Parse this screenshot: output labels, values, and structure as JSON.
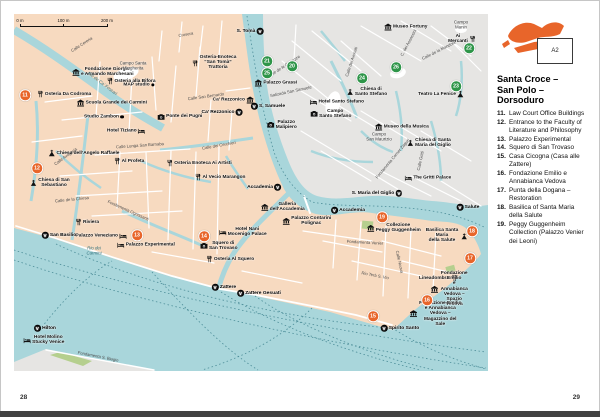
{
  "page": {
    "left_number": "28",
    "right_number": "29"
  },
  "sidebar": {
    "locator_label": "A2",
    "title": "Santa Croce –\nSan Polo –\nDorsoduro",
    "list": [
      {
        "num": "11.",
        "text": "Law Court Office Buildings"
      },
      {
        "num": "12.",
        "text": "Entrance to the Faculty of Literature and Philosophy"
      },
      {
        "num": "13.",
        "text": "Palazzo Experimental"
      },
      {
        "num": "14.",
        "text": "Squero di San Trovaso"
      },
      {
        "num": "15.",
        "text": "Casa Cicogna (Casa alle Zattere)"
      },
      {
        "num": "16.",
        "text": "Fondazione Emilio e Annabianca Vedova"
      },
      {
        "num": "17.",
        "text": "Punta della Dogana – Restoration"
      },
      {
        "num": "18.",
        "text": "Basilica of Santa Maria della Salute"
      },
      {
        "num": "19.",
        "text": "Peggy Guggenheim Collection (Palazzo Venier dei Leoni)"
      }
    ]
  },
  "map": {
    "scale_bar": {
      "labels": [
        "0 m",
        "100 m",
        "200 m"
      ]
    },
    "colors": {
      "water": "#A9D6DB",
      "land": "#F7DAC0",
      "district_other": "#E6E5E3",
      "sight_orange": "#E8652A",
      "ref_green": "#2E9549",
      "park": "#B5CF8E"
    },
    "sights": [
      {
        "n": "11",
        "x": 25,
        "y": 95
      },
      {
        "n": "12",
        "x": 37,
        "y": 168
      },
      {
        "n": "13",
        "x": 137,
        "y": 235
      },
      {
        "n": "14",
        "x": 204,
        "y": 236
      },
      {
        "n": "15",
        "x": 373,
        "y": 316
      },
      {
        "n": "16",
        "x": 427,
        "y": 300
      },
      {
        "n": "17",
        "x": 470,
        "y": 258
      },
      {
        "n": "18",
        "x": 472,
        "y": 231
      },
      {
        "n": "19",
        "x": 382,
        "y": 217
      }
    ],
    "refs": [
      {
        "n": "20",
        "x": 292,
        "y": 66
      },
      {
        "n": "21",
        "x": 267,
        "y": 61
      },
      {
        "n": "25",
        "x": 267,
        "y": 73
      },
      {
        "n": "24",
        "x": 362,
        "y": 78
      },
      {
        "n": "26",
        "x": 396,
        "y": 67
      },
      {
        "n": "23",
        "x": 456,
        "y": 86
      },
      {
        "n": "22",
        "x": 469,
        "y": 48
      }
    ],
    "labels": [
      {
        "t": "Fondazione Giorgio\ne Armando Marchesani",
        "icon": "museum-icon",
        "x": 103,
        "y": 72
      },
      {
        "t": "MAP studio",
        "icon": "dot-icon",
        "side": "r",
        "x": 139,
        "y": 85
      },
      {
        "t": "Osteria Da Codroma",
        "icon": "restaurant-icon",
        "x": 64,
        "y": 94
      },
      {
        "t": "Campo Santa\nMargherita",
        "cls": "place",
        "x": 133,
        "y": 66
      },
      {
        "t": "Osteria alla Bifora",
        "icon": "restaurant-icon",
        "x": 131,
        "y": 81
      },
      {
        "t": "Scuola Grande dei Carmini",
        "icon": "museum-icon",
        "x": 112,
        "y": 103
      },
      {
        "t": "Studio Zambon",
        "icon": "dot-icon",
        "side": "r",
        "x": 104,
        "y": 117
      },
      {
        "t": "Osteria-Enoteca\n“San Tomà”\nTrattoria",
        "icon": "restaurant-icon",
        "x": 214,
        "y": 63
      },
      {
        "t": "Ca’ Rezzonico",
        "icon": "museum-icon",
        "side": "r",
        "x": 233,
        "y": 100
      },
      {
        "t": "Ponte dei Pugni",
        "icon": "camera-icon",
        "x": 180,
        "y": 117
      },
      {
        "t": "Hotel Tiziano",
        "icon": "hotel-icon",
        "side": "r",
        "x": 126,
        "y": 131
      },
      {
        "t": "Chiesa dell’Angelo Raffaele",
        "icon": "church-icon",
        "x": 84,
        "y": 153
      },
      {
        "t": "Al Profeta",
        "icon": "restaurant-icon",
        "x": 129,
        "y": 161
      },
      {
        "t": "Chiesa di San\nSebastiano",
        "icon": "church-icon",
        "x": 50,
        "y": 183
      },
      {
        "t": "Osteria Enoteca Ai Artisti",
        "icon": "restaurant-icon",
        "x": 199,
        "y": 163
      },
      {
        "t": "Al Vecio Marangon",
        "icon": "restaurant-icon",
        "x": 220,
        "y": 177
      },
      {
        "t": "Riviera",
        "icon": "restaurant-icon",
        "x": 87,
        "y": 222
      },
      {
        "t": "Palazzo Veneziano",
        "icon": "hotel-icon",
        "side": "r",
        "x": 101,
        "y": 236
      },
      {
        "t": "Palazzo Experimental",
        "icon": "hotel-icon",
        "x": 146,
        "y": 245
      },
      {
        "t": "Squero di\nSan Trovaso",
        "icon": "camera-icon",
        "x": 219,
        "y": 246
      },
      {
        "t": "Hotel Nani\nMocenigo Palace",
        "icon": "hotel-icon",
        "x": 243,
        "y": 232
      },
      {
        "t": "Osteria Al Squero",
        "icon": "restaurant-icon",
        "x": 230,
        "y": 259
      },
      {
        "t": "Galleria\ndell’Accademia",
        "icon": "museum-icon",
        "x": 283,
        "y": 207
      },
      {
        "t": "Palazzo Contarini\nPolignac",
        "icon": "museum-icon",
        "x": 307,
        "y": 221
      },
      {
        "t": "Collezione\nPeggy Guggenheim",
        "icon": "museum-icon",
        "x": 394,
        "y": 228
      },
      {
        "t": "Basilica Santa Maria\ndella Salute",
        "icon": "church-icon",
        "side": "r",
        "x": 446,
        "y": 236
      },
      {
        "t": "Lineadombra",
        "icon": "restaurant-icon",
        "side": "r",
        "x": 438,
        "y": 278
      },
      {
        "t": "Fondazione Emilio\ne Annabianca Vedova –\nSpazio Vedova",
        "icon": "museum-icon",
        "x": 450,
        "y": 289
      },
      {
        "t": "Fondazione Emilio\ne Annabianca Vedova –\nMagazzino del Sale",
        "icon": "museum-icon",
        "x": 436,
        "y": 314
      },
      {
        "t": "Museo Fortuny",
        "icon": "museum-icon",
        "x": 406,
        "y": 27
      },
      {
        "t": "Campo\nManin",
        "cls": "place",
        "x": 461,
        "y": 25
      },
      {
        "t": "Ai Mercanti",
        "icon": "restaurant-icon",
        "side": "r",
        "x": 462,
        "y": 39
      },
      {
        "t": "Palazzo Grassi",
        "icon": "museum-icon",
        "x": 276,
        "y": 83
      },
      {
        "t": "Palazzo\nMalipiero",
        "icon": "camera-icon",
        "x": 282,
        "y": 125
      },
      {
        "t": "Chiesa di\nSanto Stefano",
        "icon": "church-icon",
        "x": 367,
        "y": 92
      },
      {
        "t": "Hotel Santo Stefano",
        "icon": "hotel-icon",
        "x": 337,
        "y": 102
      },
      {
        "t": "Campo\nSanto Stefano",
        "icon": "camera-icon",
        "x": 331,
        "y": 114
      },
      {
        "t": "Museo della Musica",
        "icon": "museum-icon",
        "x": 402,
        "y": 127
      },
      {
        "t": "Campo\nSan Maurizio",
        "cls": "place",
        "x": 379,
        "y": 137
      },
      {
        "t": "Chiesa di Santa\nMaria del Giglio",
        "icon": "church-icon",
        "x": 429,
        "y": 143
      },
      {
        "t": "The Gritti Palace",
        "icon": "hotel-icon",
        "x": 428,
        "y": 178
      },
      {
        "t": "Teatro La Fenice",
        "icon": "church-icon",
        "side": "r",
        "x": 441,
        "y": 94
      },
      {
        "t": "Hotel Molino\nStucky Venice",
        "icon": "hotel-icon",
        "x": 44,
        "y": 340
      },
      {
        "t": "S. Tomà",
        "cls": "vap",
        "icon": "vaporetto-icon",
        "side": "r",
        "x": 250,
        "y": 31
      },
      {
        "t": "Ca’ Rezzonico",
        "cls": "vap",
        "icon": "vaporetto-icon",
        "side": "r",
        "x": 222,
        "y": 112
      },
      {
        "t": "S. Samuele",
        "cls": "vap",
        "icon": "vaporetto-icon",
        "x": 268,
        "y": 106
      },
      {
        "t": "Accademia",
        "cls": "vap",
        "icon": "vaporetto-icon",
        "side": "r",
        "x": 264,
        "y": 187
      },
      {
        "t": "Accademia",
        "cls": "vap",
        "icon": "vaporetto-icon",
        "x": 348,
        "y": 210
      },
      {
        "t": "S. Maria del Giglio",
        "cls": "vap",
        "icon": "vaporetto-icon",
        "side": "r",
        "x": 377,
        "y": 193
      },
      {
        "t": "Salute",
        "cls": "vap",
        "icon": "vaporetto-icon",
        "x": 468,
        "y": 207
      },
      {
        "t": "San Basilio",
        "cls": "vap",
        "icon": "vaporetto-icon",
        "x": 59,
        "y": 235
      },
      {
        "t": "Zattere",
        "cls": "vap",
        "icon": "vaporetto-icon",
        "x": 224,
        "y": 287
      },
      {
        "t": "Zattere Gesuati",
        "cls": "vap",
        "icon": "vaporetto-icon",
        "x": 259,
        "y": 293
      },
      {
        "t": "Spirito Santo",
        "cls": "vap",
        "icon": "vaporetto-icon",
        "x": 400,
        "y": 328
      },
      {
        "t": "Hilton",
        "cls": "vap",
        "icon": "vaporetto-icon",
        "x": 45,
        "y": 328
      },
      {
        "t": "Calle Cereria",
        "cls": "street",
        "x": 82,
        "y": 45,
        "r": -33
      },
      {
        "t": "Rio de Ca’ Foscari",
        "cls": "water",
        "x": 102,
        "y": 84,
        "r": 37
      },
      {
        "t": "Calle San Bernardo",
        "cls": "street",
        "x": 206,
        "y": 97,
        "r": -8
      },
      {
        "t": "Calle Lunga San Barnaba",
        "cls": "street",
        "x": 140,
        "y": 146,
        "r": -4
      },
      {
        "t": "Calle Avogaria",
        "cls": "street",
        "x": 66,
        "y": 157,
        "r": -36
      },
      {
        "t": "Calle de la Chiesa",
        "cls": "street",
        "x": 72,
        "y": 200,
        "r": -6
      },
      {
        "t": "Fondamenta Ognissanti",
        "cls": "street",
        "x": 128,
        "y": 211,
        "r": 24
      },
      {
        "t": "Calle dei Cerchieri",
        "cls": "street",
        "x": 219,
        "y": 146,
        "r": -10
      },
      {
        "t": "Rio Terà S. Vio",
        "cls": "street",
        "x": 375,
        "y": 276,
        "r": 11
      },
      {
        "t": "Fondamenta Venier",
        "cls": "street",
        "x": 365,
        "y": 243,
        "r": 3
      },
      {
        "t": "Calle Nuova",
        "cls": "street",
        "x": 399,
        "y": 262,
        "r": 78
      },
      {
        "t": "Calle de la Mandola",
        "cls": "street",
        "x": 439,
        "y": 51,
        "r": -27
      },
      {
        "t": "C. dei Assassini",
        "cls": "street",
        "x": 409,
        "y": 43,
        "r": -62
      },
      {
        "t": "Calle dei Avocati",
        "cls": "street",
        "x": 352,
        "y": 62,
        "r": -72
      },
      {
        "t": "Salizada San Samuele",
        "cls": "street",
        "x": 291,
        "y": 92,
        "r": -12
      },
      {
        "t": "Fondamenta Corner Zaguri",
        "cls": "street",
        "x": 393,
        "y": 159,
        "r": -50
      },
      {
        "t": "Calle Gritti",
        "cls": "street",
        "x": 421,
        "y": 161,
        "r": -78
      },
      {
        "t": "Fondamenta S. Biagio",
        "cls": "street",
        "x": 98,
        "y": 357,
        "r": 11
      },
      {
        "t": "Rio dei\nCarmini",
        "cls": "water",
        "x": 94,
        "y": 251
      },
      {
        "t": "Crosera",
        "cls": "street",
        "x": 186,
        "y": 35,
        "r": -10
      },
      {
        "t": "Calle de le Carrozze",
        "cls": "street",
        "x": 284,
        "y": 67,
        "r": -33
      }
    ]
  }
}
